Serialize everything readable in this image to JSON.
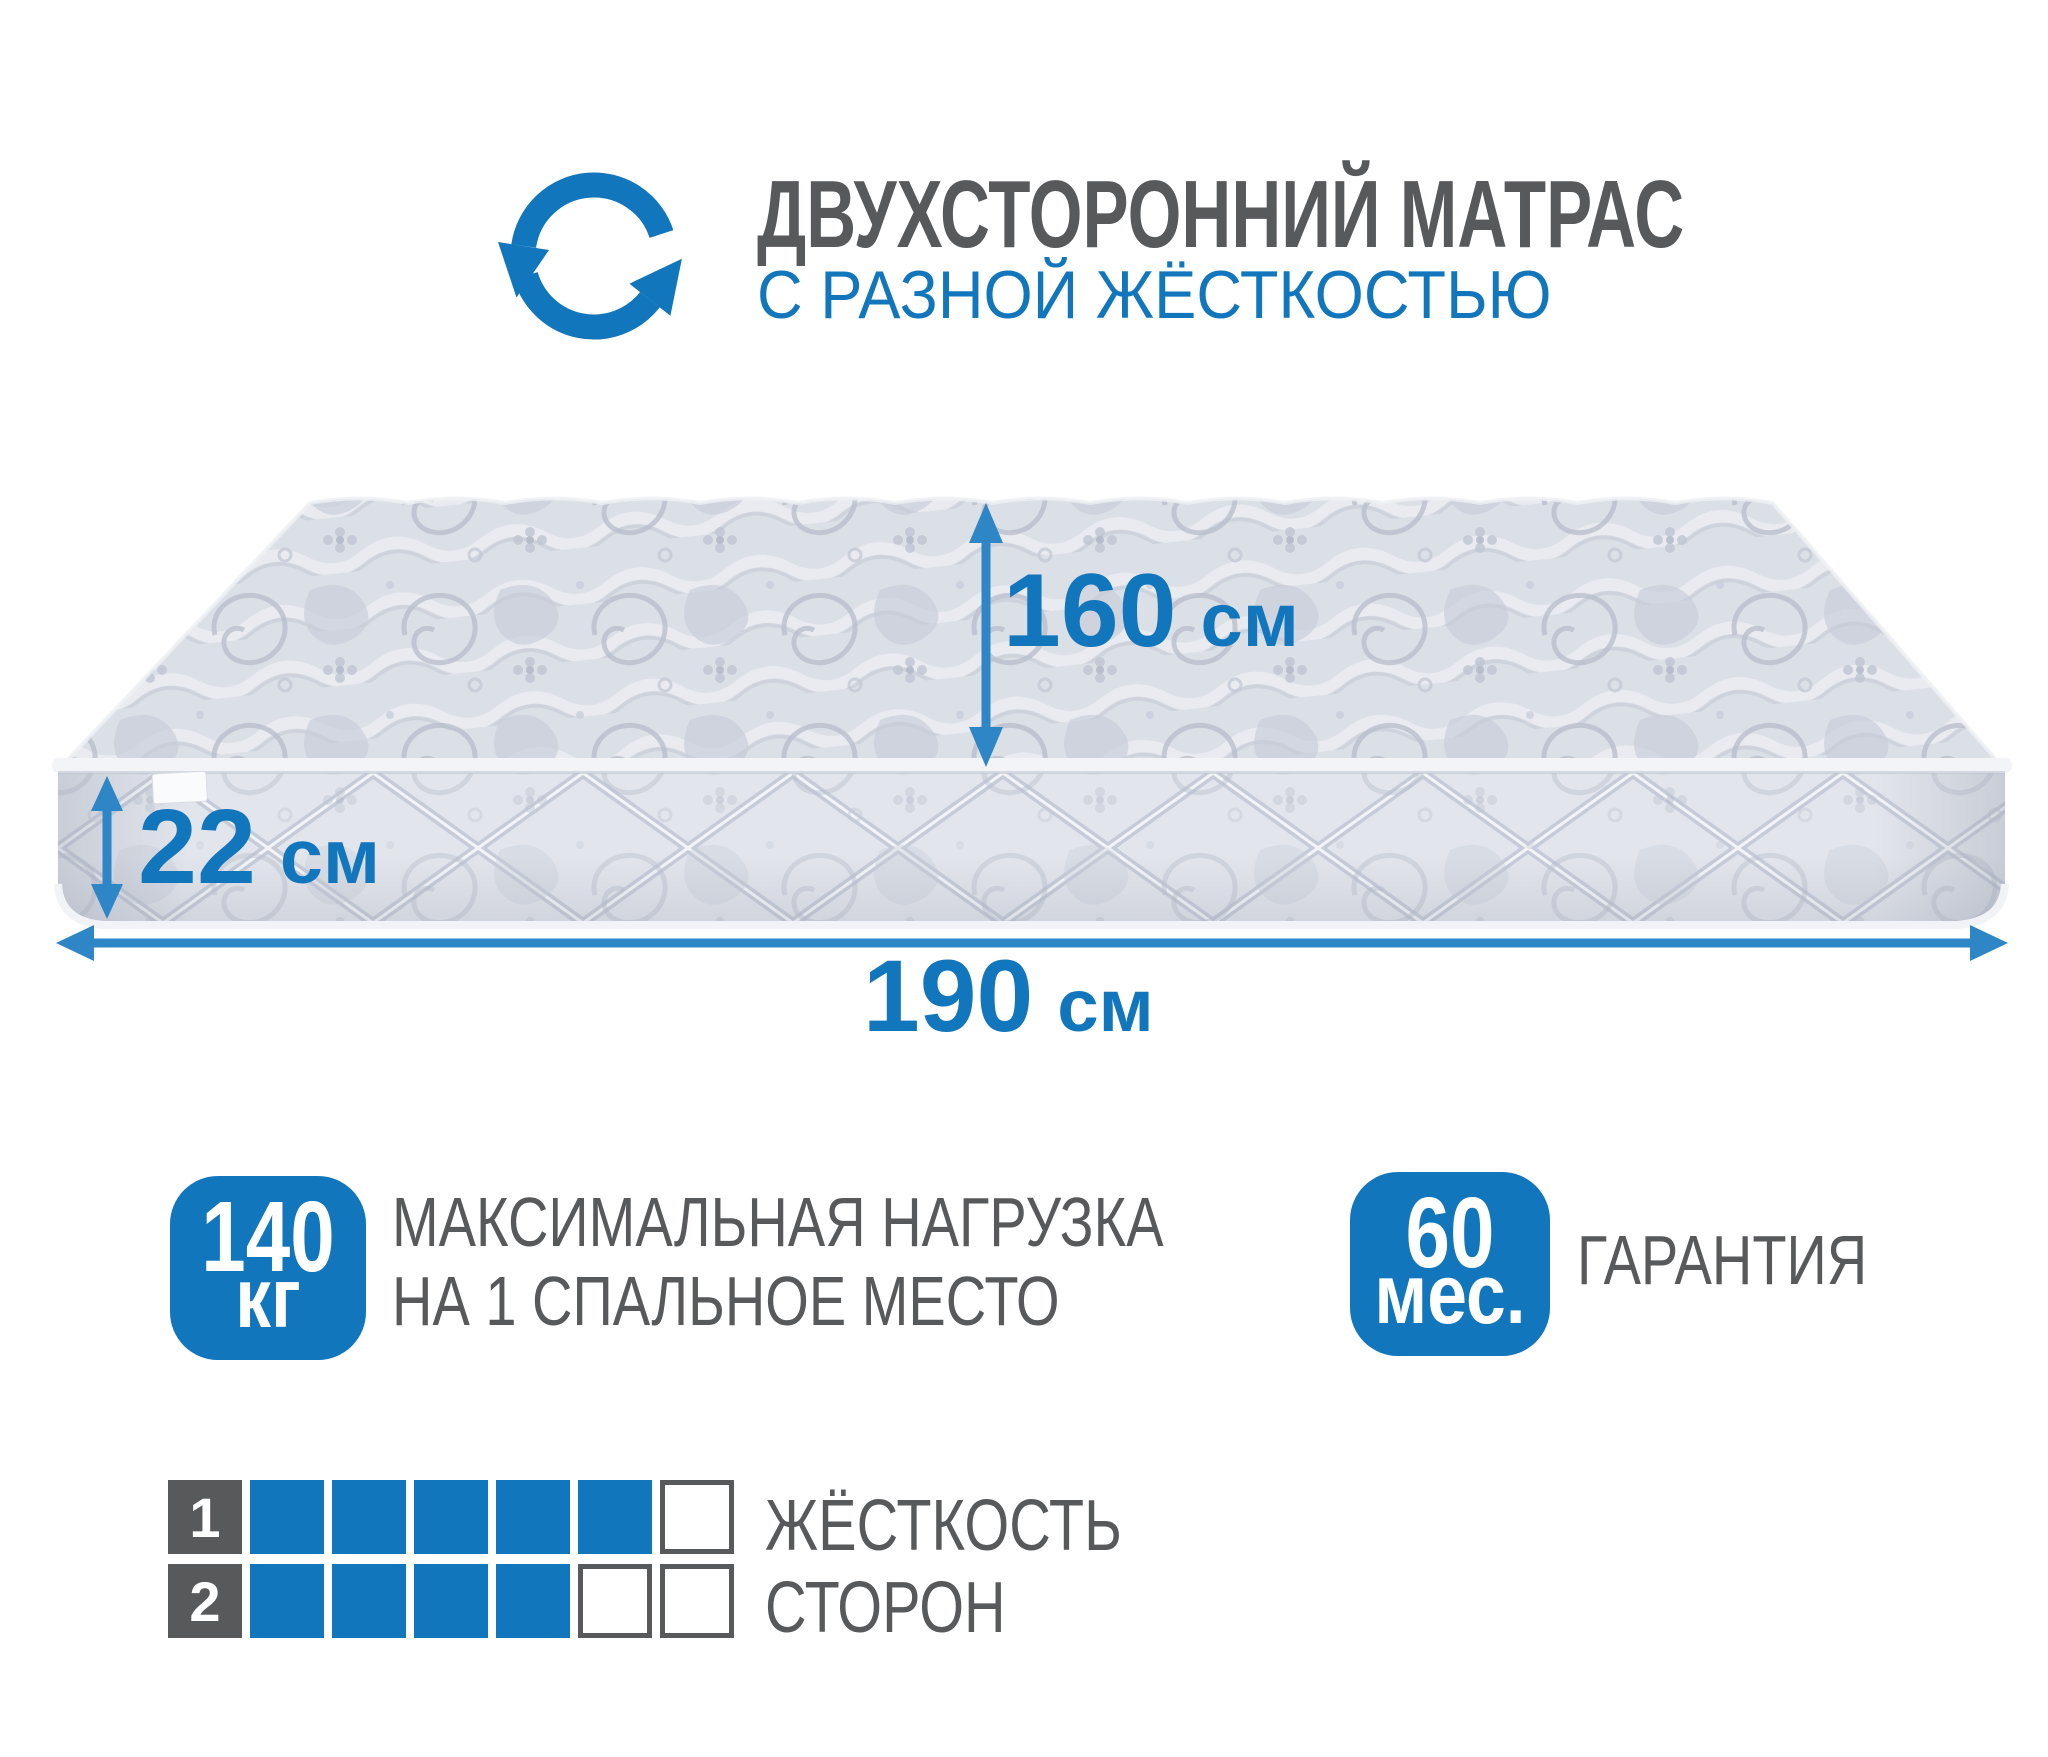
{
  "colors": {
    "accent_blue": "#1276bd",
    "arrow_blue": "#2e86c6",
    "text_gray": "#58595b",
    "mattress_base": "#dbdfe6",
    "mattress_pattern": "#b9bfcc",
    "badge_text": "#ffffff"
  },
  "icons": {
    "header_icon": "rotate-arrows-icon",
    "dimension_arrows": "double-headed-arrow-icon"
  },
  "header": {
    "title_line1": "ДВУХСТОРОННИЙ МАТРАС",
    "title_line2": "С РАЗНОЙ ЖЁСТКОСТЬЮ"
  },
  "mattress": {
    "dimensions": {
      "width": {
        "value": "160",
        "unit": "см"
      },
      "height": {
        "value": "22",
        "unit": "см"
      },
      "length": {
        "value": "190",
        "unit": "см"
      }
    }
  },
  "badges": {
    "max_load": {
      "value": "140",
      "unit": "кг",
      "label_line1": "МАКСИМАЛЬНАЯ НАГРУЗКА",
      "label_line2": "НА 1 СПАЛЬНОЕ МЕСТО"
    },
    "warranty": {
      "value": "60",
      "unit": "мес.",
      "label": "ГАРАНТИЯ"
    }
  },
  "firmness": {
    "caption_line1": "ЖЁСТКОСТЬ",
    "caption_line2": "СТОРОН",
    "rows": [
      {
        "label": "1",
        "filled": 5,
        "empty": 1
      },
      {
        "label": "2",
        "filled": 4,
        "empty": 2
      }
    ]
  }
}
